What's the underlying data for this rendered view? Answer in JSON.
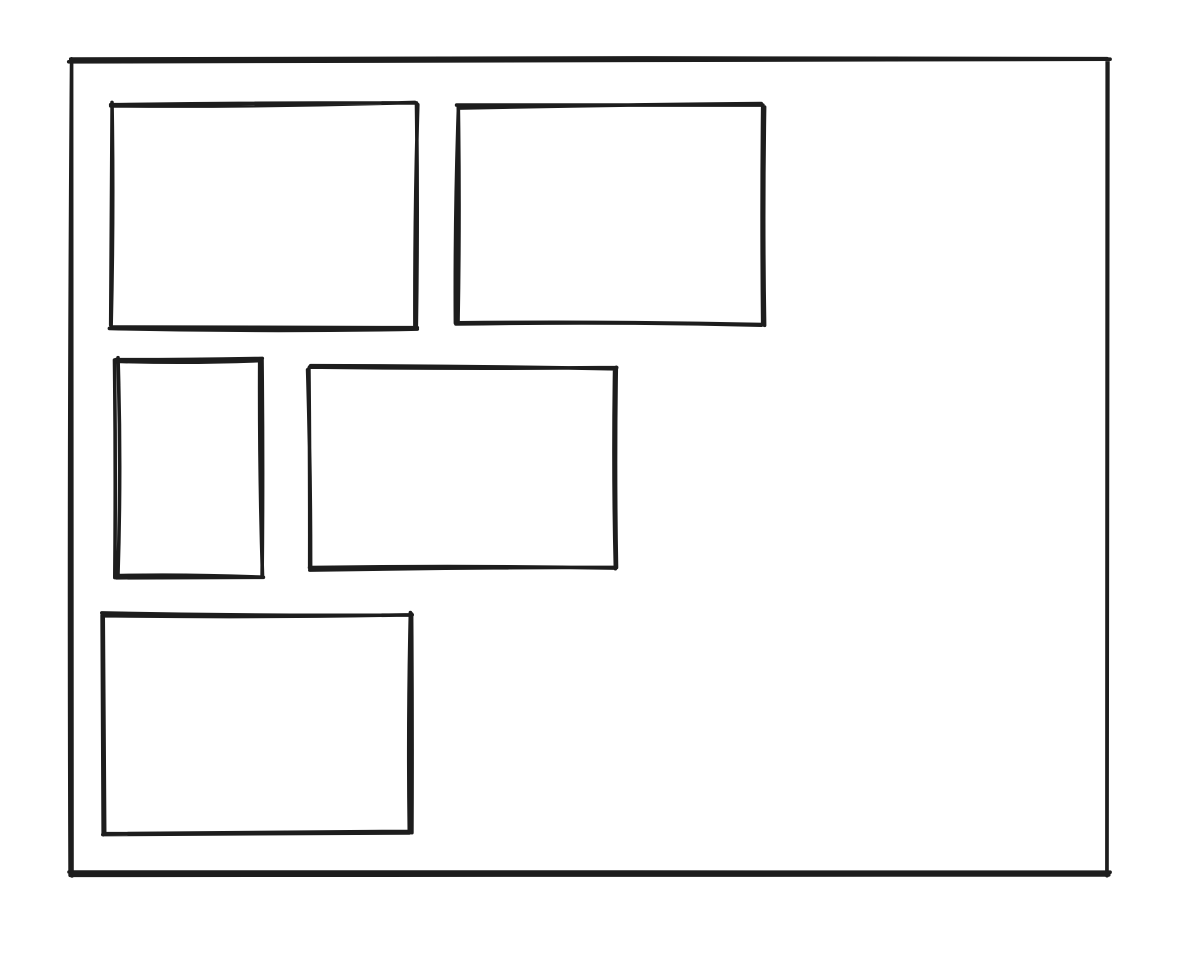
{
  "canvas": {
    "background": "#ffffff",
    "stroke_color": "#1d1d1d",
    "stroke_width": 3.6,
    "style": "hand-drawn-sketch",
    "width": 1192,
    "height": 956
  },
  "shapes": [
    {
      "name": "outer-frame",
      "type": "rectangle",
      "x": 71,
      "y": 60,
      "width": 1037,
      "height": 814
    },
    {
      "name": "box-top-left",
      "type": "rectangle",
      "x": 111,
      "y": 104,
      "width": 306,
      "height": 223
    },
    {
      "name": "box-top-right",
      "type": "rectangle",
      "x": 457,
      "y": 106,
      "width": 306,
      "height": 218
    },
    {
      "name": "box-middle-left",
      "type": "rectangle",
      "x": 116,
      "y": 359,
      "width": 146,
      "height": 218
    },
    {
      "name": "box-middle-center",
      "type": "rectangle",
      "x": 310,
      "y": 368,
      "width": 306,
      "height": 200
    },
    {
      "name": "box-bottom-left",
      "type": "rectangle",
      "x": 104,
      "y": 615,
      "width": 307,
      "height": 218
    }
  ]
}
